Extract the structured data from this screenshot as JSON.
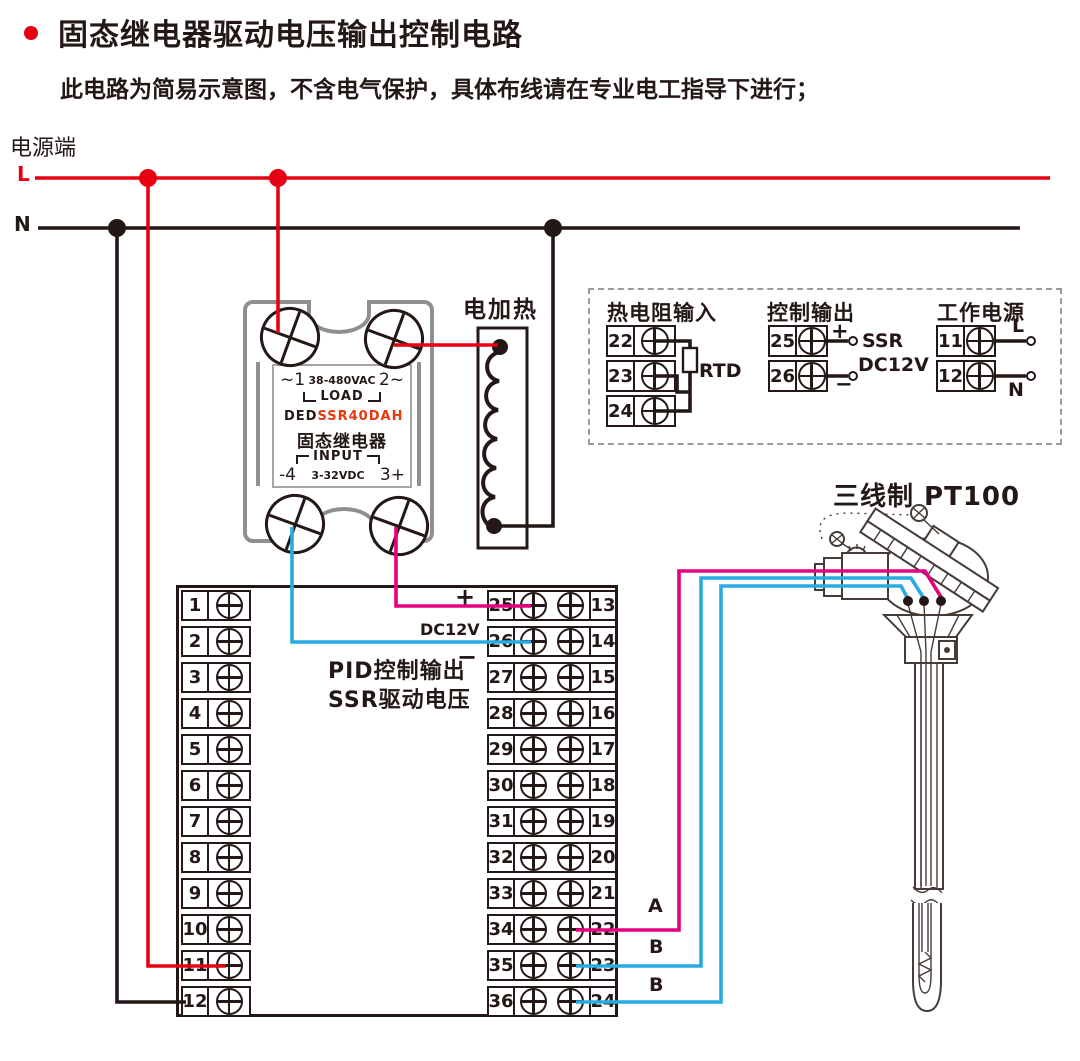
{
  "colors": {
    "red": "#e60012",
    "magenta": "#e4007f",
    "blue": "#29abe2",
    "line": "#231815",
    "gray": "#8f8f8f",
    "modelred": "#e8380d"
  },
  "header": {
    "title": "固态继电器驱动电压输出控制电路",
    "subtitle": "此电路为简易示意图，不含电气保护，具体布线请在专业电工指导下进行；"
  },
  "power": {
    "label": "电源端",
    "l": "L",
    "n": "N"
  },
  "ssr": {
    "top_left": "~1",
    "voltage": "38-480VAC",
    "top_right": "2~",
    "load": "LOAD",
    "brand": "DED",
    "model": "SSR40DAH",
    "name": "固态继电器",
    "input": "INPUT",
    "bottom_left": "-4",
    "control_voltage": "3-32VDC",
    "bottom_right": "3+"
  },
  "heater": {
    "label": "电加热"
  },
  "panel": {
    "rtd": {
      "title": "热电阻输入",
      "terminals": [
        "22",
        "23",
        "24"
      ],
      "label": "RTD"
    },
    "control": {
      "title": "控制输出",
      "terminals": [
        "25",
        "26"
      ],
      "plus": "+",
      "minus": "−",
      "ssr_label": "SSR",
      "dc_label": "DC12V"
    },
    "supply": {
      "title": "工作电源",
      "terminals": [
        "11",
        "12"
      ],
      "l": "L",
      "n": "N"
    }
  },
  "pt100": {
    "label": "三线制  PT100"
  },
  "block": {
    "left": [
      "1",
      "2",
      "3",
      "4",
      "5",
      "6",
      "7",
      "8",
      "9",
      "10",
      "11",
      "12"
    ],
    "mid_left": [
      "25",
      "26",
      "27",
      "28",
      "29",
      "30",
      "31",
      "32",
      "33",
      "34",
      "35",
      "36"
    ],
    "mid_right": [
      "13",
      "14",
      "15",
      "16",
      "17",
      "18",
      "19",
      "20",
      "21",
      "22",
      "23",
      "24"
    ],
    "plus": "+",
    "dc_label": "DC12V",
    "minus": "−",
    "pid_line1": "PID控制输出",
    "pid_line2": "SSR驱动电压",
    "wire_labels": [
      "A",
      "B",
      "B"
    ]
  }
}
